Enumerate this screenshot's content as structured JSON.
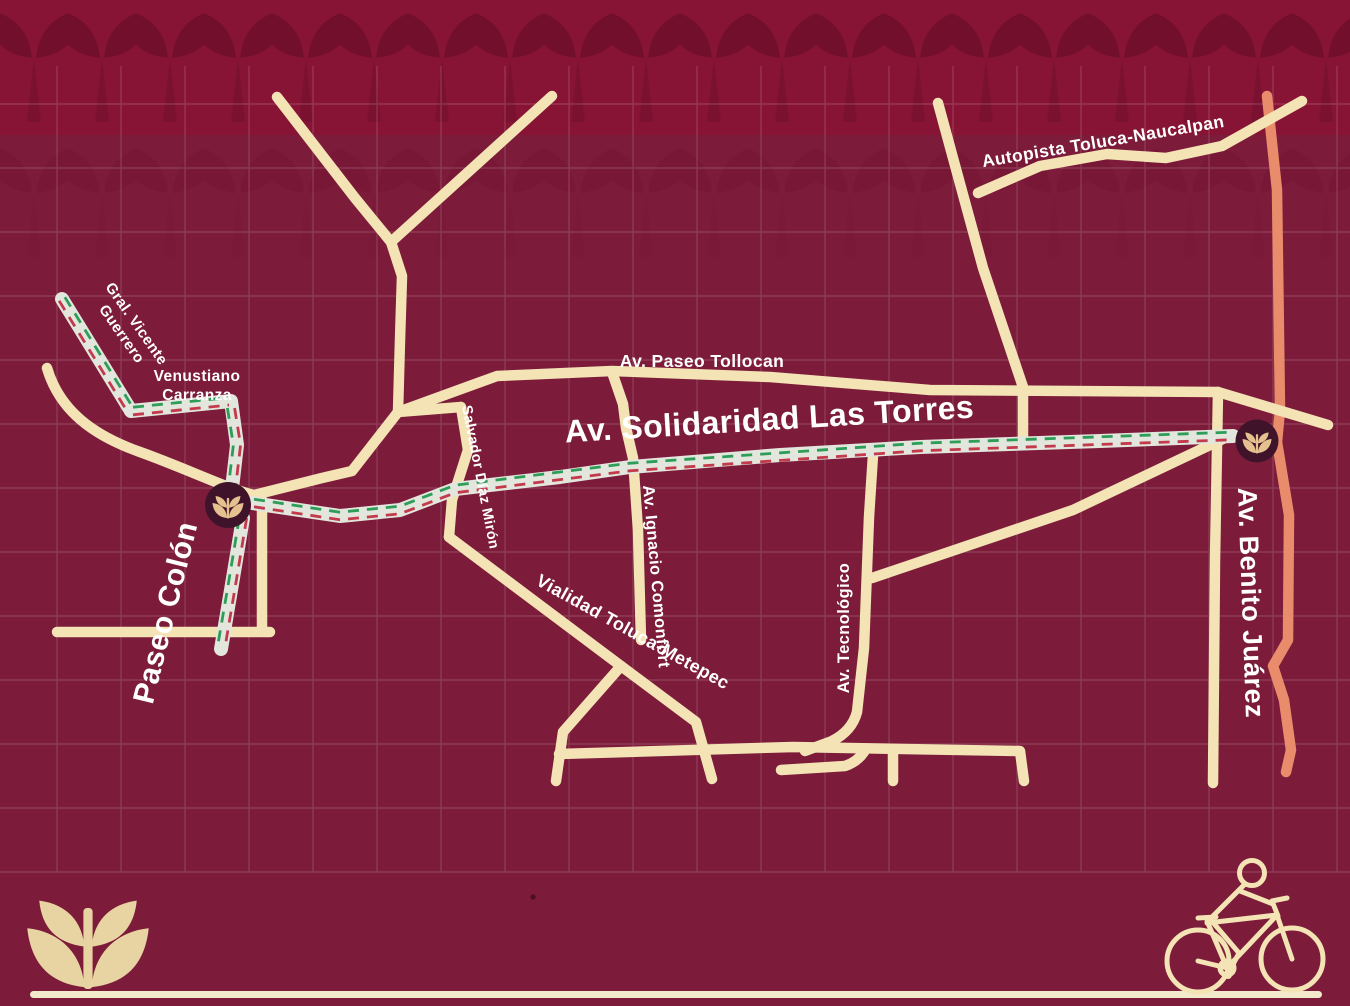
{
  "map": {
    "street_labels": {
      "paseo_tollocan": "Av. Paseo Tollocan",
      "solidaridad": "Av. Solidaridad Las Torres",
      "autopista": "Autopista Toluca-Naucalpan",
      "vicente_guerrero_line1": "Gral. Vicente",
      "vicente_guerrero_line2": "Guerrero",
      "venustiano_carranza_line1": "Venustiano",
      "venustiano_carranza_line2": "Carranza",
      "paseo_colon": "Paseo Colón",
      "salvador_diaz_miron": "Salvador Díaz Mirón",
      "ignacio_comonfort": "Av. Ignacio Comonfort",
      "tecnologico": "Av. Tecnológico",
      "vialidad_toluca_metepec": "Vialidad Toluca-Metepec",
      "benito_juarez": "Av. Benito Juárez"
    },
    "markers": [
      {
        "name": "route-endpoint-paseo-colon",
        "icon": "plant-logo-icon"
      },
      {
        "name": "route-endpoint-benito-juarez",
        "icon": "plant-logo-icon"
      }
    ],
    "icons": {
      "bottom_left": "plant-logo-icon",
      "bottom_right": "cyclist-icon"
    }
  },
  "colors": {
    "bg": "#7C1B3A",
    "band_bg": "#871335",
    "band_motif": "#6D0E2C",
    "grid": "#FFFFFF",
    "road": "#F3E3B5",
    "road_orange": "#E98C6B",
    "route_base": "#E2E6DD",
    "route_green": "#2E9D57",
    "route_red": "#C23A4B",
    "marker_bg": "#3F142A",
    "marker_icon": "#E5C190",
    "label": "#FFFFFF",
    "logo": "#E8D3A2",
    "baseline": "#F3E9CB"
  }
}
